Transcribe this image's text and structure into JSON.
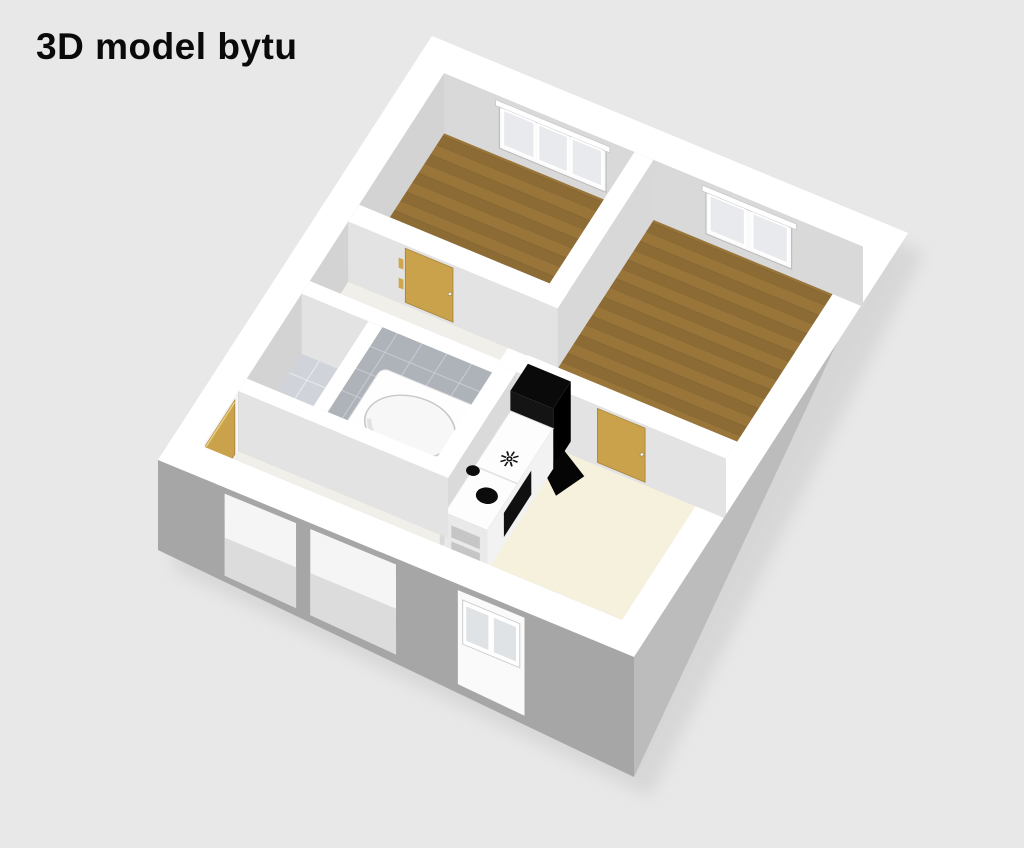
{
  "title": "3D model bytu",
  "colors": {
    "bg": "#e8e8e8",
    "title": "#0a0a0a",
    "wall_top": "#ffffff",
    "face_north": "#d9d9d9",
    "face_side": "#d3d3d3",
    "face_inner": "#d8d8d8",
    "face_south": "#e3e3e3",
    "face_light": "#e4e4e4",
    "ext_south": "#a6a6a6",
    "ext_east": "#bcbcbc",
    "wood_light": "#997539",
    "wood_dark": "#8c6c34",
    "floor_cream": "#f5f1dc",
    "floor_hall": "#f1efe9",
    "floor_bath": "#fafafa",
    "tile_wall": "#aeb3ba",
    "tile_grout": "#c8ccd2",
    "tile_floor": "#d0d4da",
    "tile_floor_grout": "#e9ebef",
    "door_wood": "#c9a24b",
    "door_edge": "#e8cd7d",
    "door_line": "#a8853a",
    "glass": "#e8eaed",
    "window_frame": "#fbfbfb",
    "appliance_black": "#0a0a0a",
    "tub_white": "#fefefe",
    "shadow": "#c9c9c9"
  },
  "scene": {
    "type": "isometric-floorplan",
    "rooms": [
      "bedroom-1",
      "bedroom-2",
      "bathroom",
      "wc",
      "corridor",
      "entry-hall",
      "living-kitchen"
    ],
    "objects": [
      "triple-window",
      "double-window",
      "facade-window",
      "bathtub",
      "kitchen-counter",
      "stove-burners",
      "oven",
      "fridge",
      "door-bedroom-1",
      "door-bedroom-2",
      "door-entrance",
      "door-open-leaf"
    ]
  }
}
